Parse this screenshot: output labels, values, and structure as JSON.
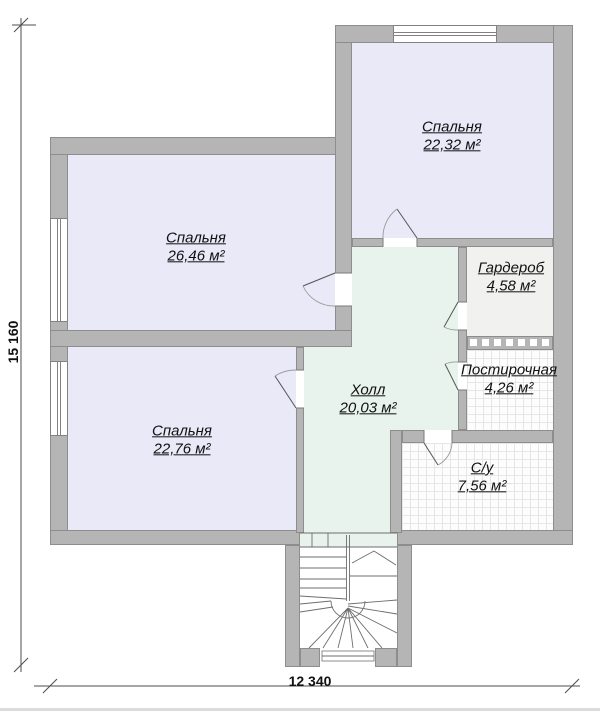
{
  "title": "Floor plan — second level",
  "plan": {
    "rooms": [
      {
        "key": "bedroom-top",
        "name": "Спальня",
        "area": "22,32 м²"
      },
      {
        "key": "bedroom-middle",
        "name": "Спальня",
        "area": "26,46 м²"
      },
      {
        "key": "bedroom-bottom",
        "name": "Спальня",
        "area": "22,76 м²"
      },
      {
        "key": "hall",
        "name": "Холл",
        "area": "20,03 м²"
      },
      {
        "key": "wardrobe",
        "name": "Гардероб",
        "area": "4,58 м²"
      },
      {
        "key": "laundry",
        "name": "Постирочная",
        "area": "4,26 м²"
      },
      {
        "key": "bathroom",
        "name": "С/у",
        "area": "7,56 м²"
      }
    ],
    "dimensions": {
      "width": "12 340",
      "height": "15 160"
    },
    "colors": {
      "wall": "#b5b5b5",
      "wall_outline": "#8d8d8d",
      "bedroom_floor": "#e9e9f8",
      "hall_floor": "#e8f3ed",
      "wardrobe_floor": "#f1f1ef",
      "tile_grid_line": "#e6e6e6",
      "text": "#111111"
    }
  }
}
